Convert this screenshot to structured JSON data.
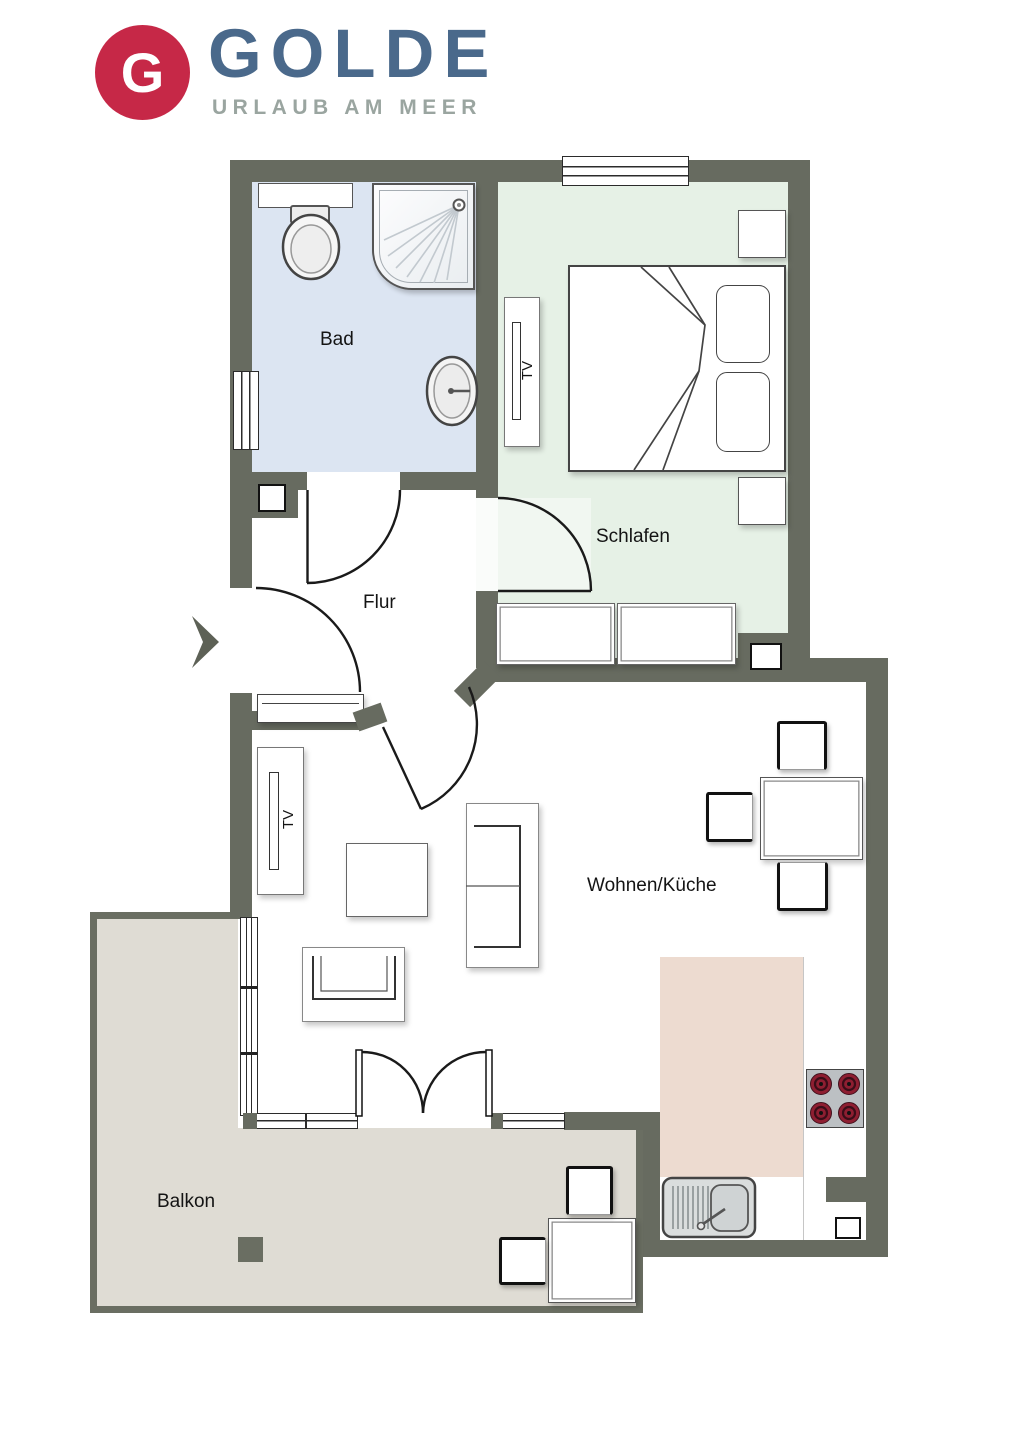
{
  "logo": {
    "monogram": "G",
    "brand": "GOLDE",
    "tagline": "URLAUB AM MEER"
  },
  "rooms": {
    "bad": {
      "label": "Bad"
    },
    "schlafen": {
      "label": "Schlafen"
    },
    "flur": {
      "label": "Flur"
    },
    "wohnen_kueche": {
      "label": "Wohnen/Küche"
    },
    "balkon": {
      "label": "Balkon"
    }
  },
  "furniture_labels": {
    "tv_schlafen": "TV",
    "tv_wohnen": "TV"
  },
  "colors": {
    "wall": "#676b60",
    "bad_floor": "#dce5f2",
    "schlafen_floor": "#e6f1e6",
    "balkon_floor": "#dfdcd4",
    "kueche_floor": "#eddbd0",
    "logo_red": "#c62847",
    "logo_blue": "#4a698b",
    "logo_gray": "#9aa5a0",
    "burner_red": "#8e1e31"
  }
}
